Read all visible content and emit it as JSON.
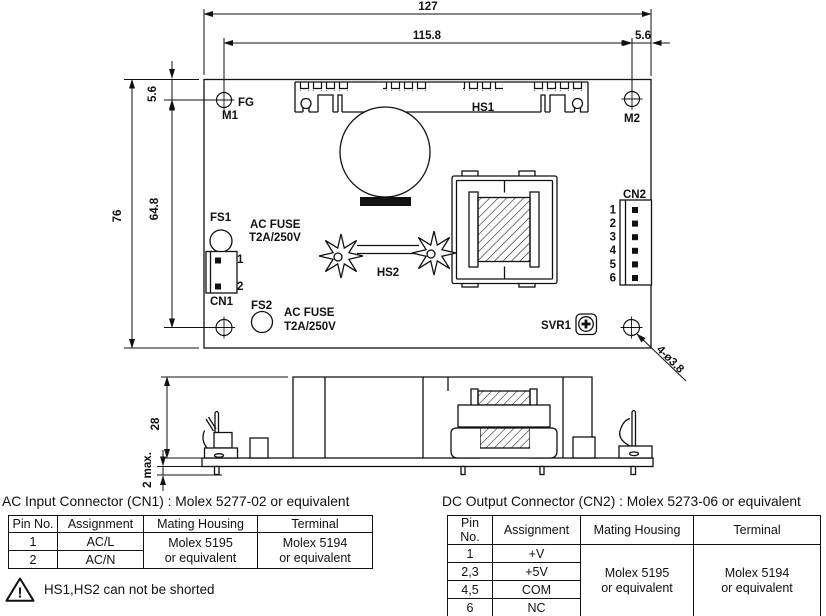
{
  "drawing": {
    "top_view": {
      "dim_total_width": "127",
      "dim_hole_span_h": "115.8",
      "dim_right_offset": "5.6",
      "dim_total_height": "76",
      "dim_hole_span_v": "64.8",
      "dim_top_offset": "5.6",
      "dim_mounting_holes": "4-ø3.8",
      "fg": "FG",
      "m1": "M1",
      "m2": "M2",
      "hs1": "HS1",
      "hs2": "HS2",
      "fs1": "FS1",
      "fs2": "FS2",
      "fuse1": {
        "line1": "AC FUSE",
        "line2": "T2A/250V"
      },
      "fuse2": {
        "line1": "AC FUSE",
        "line2": "T2A/250V"
      },
      "cn1": "CN1",
      "cn1_pins": [
        "1",
        "2"
      ],
      "cn2": "CN2",
      "cn2_pins": [
        "1",
        "2",
        "3",
        "4",
        "5",
        "6"
      ],
      "svr1": "SVR1"
    },
    "side_view": {
      "dim_height": "28",
      "dim_pin_max": "2 max."
    }
  },
  "cn1_table": {
    "title": "AC Input Connector (CN1) : Molex 5277-02 or equivalent",
    "headers": [
      "Pin No.",
      "Assignment",
      "Mating Housing",
      "Terminal"
    ],
    "rows": [
      {
        "pin": "1",
        "assignment": "AC/L"
      },
      {
        "pin": "2",
        "assignment": "AC/N"
      }
    ],
    "mating_housing": "Molex 5195\nor equivalent",
    "terminal": "Molex 5194\nor equivalent"
  },
  "cn2_table": {
    "title": "DC Output Connector (CN2) : Molex 5273-06 or equivalent",
    "headers": [
      "Pin No.",
      "Assignment",
      "Mating Housing",
      "Terminal"
    ],
    "rows": [
      {
        "pin": "1",
        "assignment": "+V"
      },
      {
        "pin": "2,3",
        "assignment": "+5V"
      },
      {
        "pin": "4,5",
        "assignment": "COM"
      },
      {
        "pin": "6",
        "assignment": "NC"
      }
    ],
    "mating_housing": "Molex 5195\nor equivalent",
    "terminal": "Molex 5194\nor equivalent"
  },
  "warning": {
    "exclamation": "!",
    "text": "HS1,HS2 can not be shorted"
  },
  "colors": {
    "ink": "#111111",
    "paper": "#ffffff"
  }
}
